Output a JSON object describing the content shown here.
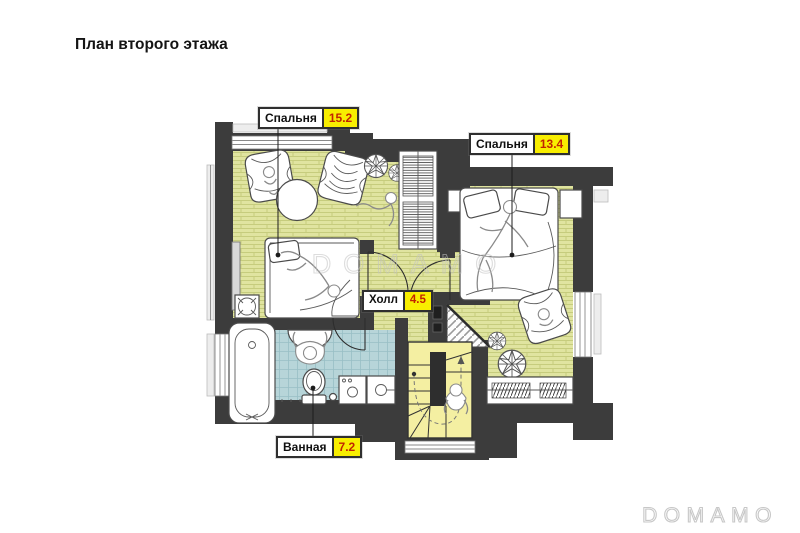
{
  "page": {
    "title": "План второго этажа"
  },
  "watermark": {
    "text": "DOMAMO"
  },
  "rooms": {
    "bedroom1": {
      "label": "Спальня",
      "area": "15.2"
    },
    "bedroom2": {
      "label": "Спальня",
      "area": "13.4"
    },
    "hall": {
      "label": "Холл",
      "area": "4.5"
    },
    "bathroom": {
      "label": "Ванная",
      "area": "7.2"
    }
  },
  "colors": {
    "wall": "#3c3c3c",
    "wood_floor": "#e0e4a0",
    "wood_line": "#c6cc7d",
    "tile_floor": "#b7d5d9",
    "tile_line": "#98bfc5",
    "stair_floor": "#f4efa2",
    "badge_bg": "#f8ee00",
    "badge_text": "#c22400",
    "label_border": "#2f2f2f",
    "watermark": "#c2c2c2",
    "furniture_stroke": "#4a4a4a",
    "window_line": "#8a8a8a"
  }
}
